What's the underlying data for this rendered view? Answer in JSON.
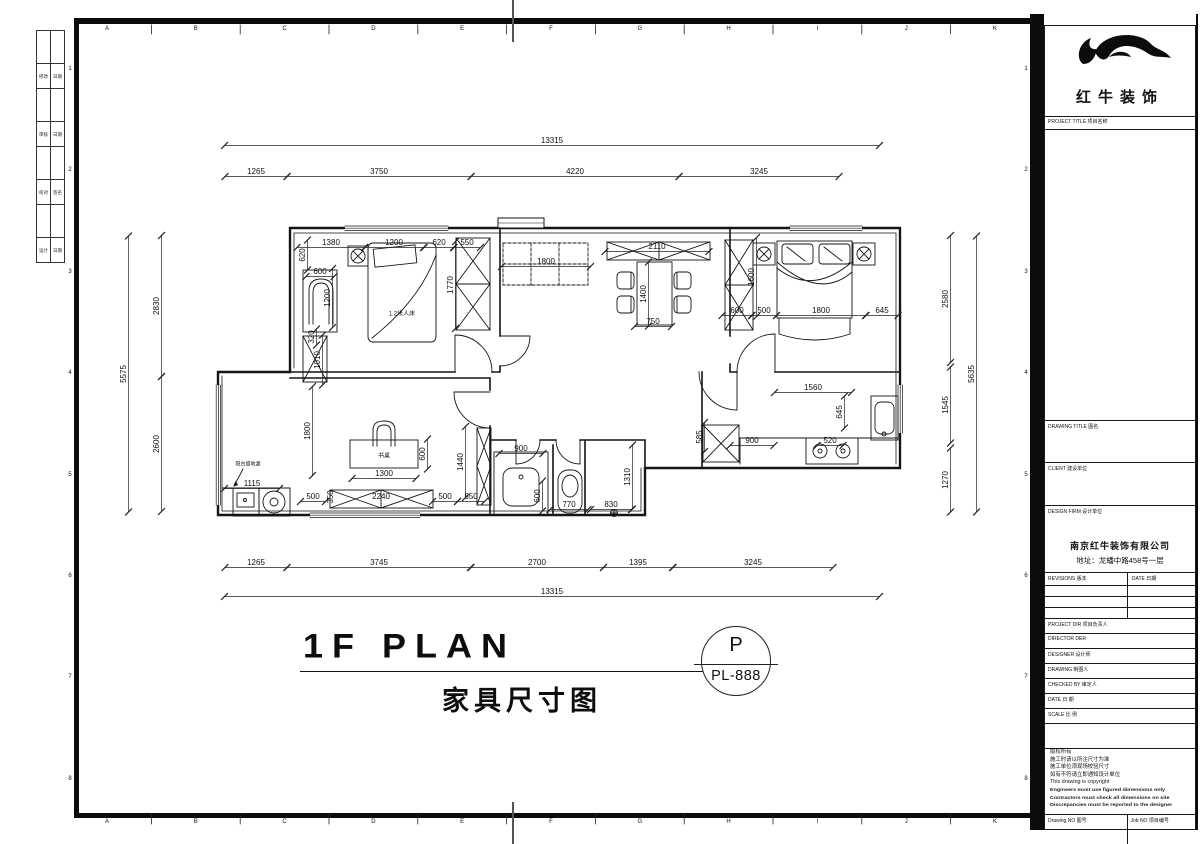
{
  "sheet": {
    "grid_letters": [
      "A",
      "B",
      "C",
      "D",
      "E",
      "F",
      "G",
      "H",
      "I",
      "J",
      "K"
    ],
    "grid_numbers": [
      "1",
      "2",
      "3",
      "4",
      "5",
      "6",
      "7",
      "8"
    ],
    "fold_rows": [
      [
        "修改",
        "日期"
      ],
      [
        "审核",
        "日期"
      ],
      [
        "校对",
        "签名"
      ],
      [
        "设计",
        "日期"
      ]
    ]
  },
  "plan": {
    "title_en": "1F PLAN",
    "title_cn": "家具尺寸图",
    "sheet_ref_letter": "P",
    "sheet_ref_no": "PL-888",
    "room_labels": [
      {
        "t": "1.2米人床",
        "x": 402,
        "y": 313,
        "s": 6
      },
      {
        "t": "书桌",
        "x": 384,
        "y": 455,
        "s": 6
      },
      {
        "t": "阳台留地漏",
        "x": 248,
        "y": 464,
        "s": 5
      }
    ],
    "dims": [
      {
        "t": "13315",
        "x": 552,
        "y": 141,
        "len": 655
      },
      {
        "t": "1265",
        "x": 256,
        "y": 172,
        "len": 62
      },
      {
        "t": "3750",
        "x": 379,
        "y": 172,
        "len": 184
      },
      {
        "t": "4220",
        "x": 575,
        "y": 172,
        "len": 208
      },
      {
        "t": "3245",
        "x": 759,
        "y": 172,
        "len": 160
      },
      {
        "t": "1265",
        "x": 256,
        "y": 563,
        "len": 62
      },
      {
        "t": "3745",
        "x": 379,
        "y": 563,
        "len": 184
      },
      {
        "t": "2700",
        "x": 537,
        "y": 563,
        "len": 133
      },
      {
        "t": "1395",
        "x": 638,
        "y": 563,
        "len": 69
      },
      {
        "t": "3245",
        "x": 753,
        "y": 563,
        "len": 160
      },
      {
        "t": "13315",
        "x": 552,
        "y": 592,
        "len": 655
      },
      {
        "t": "5575",
        "x": 124,
        "y": 374,
        "v": 1,
        "len": 276
      },
      {
        "t": "2830",
        "x": 157,
        "y": 306,
        "v": 1,
        "len": 141
      },
      {
        "t": "2600",
        "x": 157,
        "y": 444,
        "v": 1,
        "len": 135
      },
      {
        "t": "2580",
        "x": 946,
        "y": 299,
        "v": 1,
        "len": 127
      },
      {
        "t": "1545",
        "x": 946,
        "y": 405,
        "v": 1,
        "len": 76
      },
      {
        "t": "1270",
        "x": 946,
        "y": 480,
        "v": 1,
        "len": 64
      },
      {
        "t": "5635",
        "x": 972,
        "y": 374,
        "v": 1,
        "len": 276
      },
      {
        "t": "1380",
        "x": 331,
        "y": 243,
        "len": 68
      },
      {
        "t": "1200",
        "x": 394,
        "y": 243,
        "len": 59
      },
      {
        "t": "620",
        "x": 439,
        "y": 243,
        "len": 30
      },
      {
        "t": "550",
        "x": 467,
        "y": 243,
        "len": 27
      },
      {
        "t": "620",
        "x": 303,
        "y": 255,
        "v": 1,
        "len": 30
      },
      {
        "t": "600",
        "x": 320,
        "y": 272,
        "len": 28
      },
      {
        "t": "1200",
        "x": 328,
        "y": 298,
        "v": 1,
        "len": 59
      },
      {
        "t": "1770",
        "x": 451,
        "y": 285,
        "v": 1,
        "len": 87
      },
      {
        "t": "320",
        "x": 312,
        "y": 337,
        "v": 1,
        "len": 16
      },
      {
        "t": "1010",
        "x": 318,
        "y": 360,
        "v": 1,
        "len": 50
      },
      {
        "t": "1800",
        "x": 546,
        "y": 262,
        "len": 89
      },
      {
        "t": "2110",
        "x": 657,
        "y": 247,
        "len": 104
      },
      {
        "t": "1400",
        "x": 644,
        "y": 294,
        "v": 1,
        "len": 64
      },
      {
        "t": "750",
        "x": 653,
        "y": 322,
        "len": 37
      },
      {
        "t": "600",
        "x": 737,
        "y": 311,
        "len": 30
      },
      {
        "t": "500",
        "x": 764,
        "y": 311,
        "len": 25
      },
      {
        "t": "1800",
        "x": 821,
        "y": 311,
        "len": 89
      },
      {
        "t": "645",
        "x": 882,
        "y": 311,
        "len": 32
      },
      {
        "t": "1600",
        "x": 752,
        "y": 277,
        "v": 1,
        "len": 79
      },
      {
        "t": "1560",
        "x": 813,
        "y": 388,
        "len": 77
      },
      {
        "t": "645",
        "x": 840,
        "y": 412,
        "v": 1,
        "len": 32
      },
      {
        "t": "900",
        "x": 752,
        "y": 441,
        "len": 44
      },
      {
        "t": "520",
        "x": 830,
        "y": 441,
        "len": 26
      },
      {
        "t": "585",
        "x": 700,
        "y": 437,
        "v": 1,
        "len": 29
      },
      {
        "t": "900",
        "x": 521,
        "y": 449,
        "len": 44
      },
      {
        "t": "600",
        "x": 538,
        "y": 496,
        "v": 1,
        "len": 30
      },
      {
        "t": "770",
        "x": 569,
        "y": 505,
        "len": 38
      },
      {
        "t": "830",
        "x": 611,
        "y": 505,
        "len": 41
      },
      {
        "t": "1310",
        "x": 628,
        "y": 477,
        "v": 1,
        "len": 64
      },
      {
        "t": "1800",
        "x": 308,
        "y": 431,
        "v": 1,
        "len": 89
      },
      {
        "t": "1300",
        "x": 384,
        "y": 474,
        "len": 64
      },
      {
        "t": "600",
        "x": 423,
        "y": 454,
        "v": 1,
        "len": 30
      },
      {
        "t": "1440",
        "x": 461,
        "y": 462,
        "v": 1,
        "len": 71
      },
      {
        "t": "500",
        "x": 313,
        "y": 497,
        "len": 25
      },
      {
        "t": "350",
        "x": 331,
        "y": 497,
        "v": 1
      },
      {
        "t": "2240",
        "x": 381,
        "y": 497
      },
      {
        "t": "500",
        "x": 445,
        "y": 497,
        "len": 25
      },
      {
        "t": "550",
        "x": 471,
        "y": 497,
        "len": 27
      },
      {
        "t": "1115",
        "x": 252,
        "y": 484,
        "len": 55
      }
    ]
  },
  "title_block": {
    "logo_text": "红牛装饰",
    "project_title": "PROJECT TITLE  项目名称",
    "drawing_title": "DRAWING TITLE  图名",
    "client": "CLIENT  建设单位",
    "design_firm": "DESIGN FIRM  设计单位",
    "company_name": "南京红牛装饰有限公司",
    "company_addr": "地址：龙蟠中路458号一层",
    "revisions": "REVISIONS  版本",
    "rev_date": "DATE  日期",
    "rows": [
      "PROJECT DIR   项目负责人",
      "DIRECTOR DER",
      "DESIGNER      设计师",
      "DRAWING       制图人",
      "CHECKED BY  审定人",
      "DATE              日  期",
      "SCALE            比  例"
    ],
    "copyright_lines": [
      "版权所有",
      "施工时请以所注尺寸为准",
      "施工单位须现场校验尺寸",
      "如有不符请立即通知设计单位",
      "This drawing is copyright",
      "Engineers must use figured dimensions only",
      "Contractors must check all dimensions on site",
      "Discrepancies must be reported to the designer"
    ],
    "drawing_no": "Drawing NO  图号",
    "job_no": "Job NO  项目编号"
  }
}
